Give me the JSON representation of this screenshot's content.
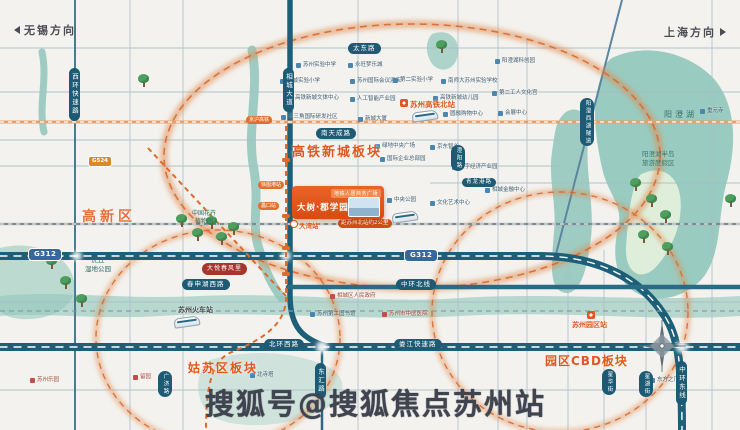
{
  "directions": {
    "wuxi": "无锡方向",
    "shanghai": "上海方向"
  },
  "districts": {
    "gaoxin": "高新区",
    "gaotie": "高铁新城板块",
    "gusu": "姑苏区板块",
    "cbd": "园区CBD板块"
  },
  "roads": {
    "taidong": "太东路",
    "nantiancheng": "南天成路",
    "xiangchengdadao": "相城大道",
    "xihuan": "西环快速路",
    "chengyang": "澄阳路",
    "qinglonggang": "青龙港路",
    "zhonghuanbei": "中环北线",
    "chunshenhuxi": "春申湖西路",
    "beihuanxi": "北环西路",
    "loujiang": "娄江快速路",
    "donghui": "东汇路",
    "zhonghuandong": "中环东线",
    "xinghua": "星华街",
    "xinghu": "星湖街",
    "guangji": "广济路",
    "yangchengtunnel": "阳澄西湖隧道",
    "g312": "G312",
    "g524": "G524",
    "jinghu_rail": "京沪高铁"
  },
  "stations": {
    "north": "苏州高铁北站",
    "railway": "苏州火车站",
    "yuanqu": "苏州园区站",
    "dawan": "大湾站",
    "xutugang": "徐图港站",
    "likou": "蠡口站"
  },
  "lakes": {
    "yangchenghu": "阳澄湖",
    "peninsula1": "阳澄湖半岛",
    "peninsula2": "旅游度假区"
  },
  "parks": {
    "huqiu1": "虎丘",
    "huqiu2": "湿地公园",
    "flower1": "中国花卉",
    "flower2": "植物园"
  },
  "project": {
    "tag": "地铁人居商务广场",
    "name": "大树·郡学园",
    "distance": "距苏州北站约2公里"
  },
  "pois": [
    {
      "label": "相城实验小学"
    },
    {
      "label": "苏州实验中学"
    },
    {
      "label": "高铁新城文体中心"
    },
    {
      "label": "长三角国际研发社区"
    },
    {
      "label": "永旺梦乐城"
    },
    {
      "label": "苏州国际会议酒店"
    },
    {
      "label": "人工智能产业园"
    },
    {
      "label": "新城大厦"
    },
    {
      "label": "第二实验小学"
    },
    {
      "label": "南师大苏州实验学校"
    },
    {
      "label": "高铁新城幼儿园"
    },
    {
      "label": "圆融购物中心"
    },
    {
      "label": "阳澄湖科创园"
    },
    {
      "label": "第二工人文化宫"
    },
    {
      "label": "会展中心"
    },
    {
      "label": "绿地中央广场"
    },
    {
      "label": "京东智谷"
    },
    {
      "label": "国际企业总部园"
    },
    {
      "label": "数字经济产业园"
    },
    {
      "label": "中央公园"
    },
    {
      "label": "文化艺术中心"
    },
    {
      "label": "相城金融中心"
    },
    {
      "label": "相城区人民政府"
    },
    {
      "label": "苏州第二图书馆"
    },
    {
      "label": "苏州市中医医院"
    },
    {
      "label": "东方之门"
    },
    {
      "label": "重元寺"
    },
    {
      "label": "留园"
    },
    {
      "label": "北寺塔"
    },
    {
      "label": "苏州乐园"
    },
    {
      "label": "大悦春风里"
    }
  ],
  "watermark": "搜狐号@搜狐焦点苏州站",
  "colors": {
    "accent_orange": "#e2571e",
    "circle_orange": "#d86a2f",
    "road_teal": "#1d5f78",
    "water_teal": "#8fc6ba",
    "label_blue": "#1d5a74"
  }
}
